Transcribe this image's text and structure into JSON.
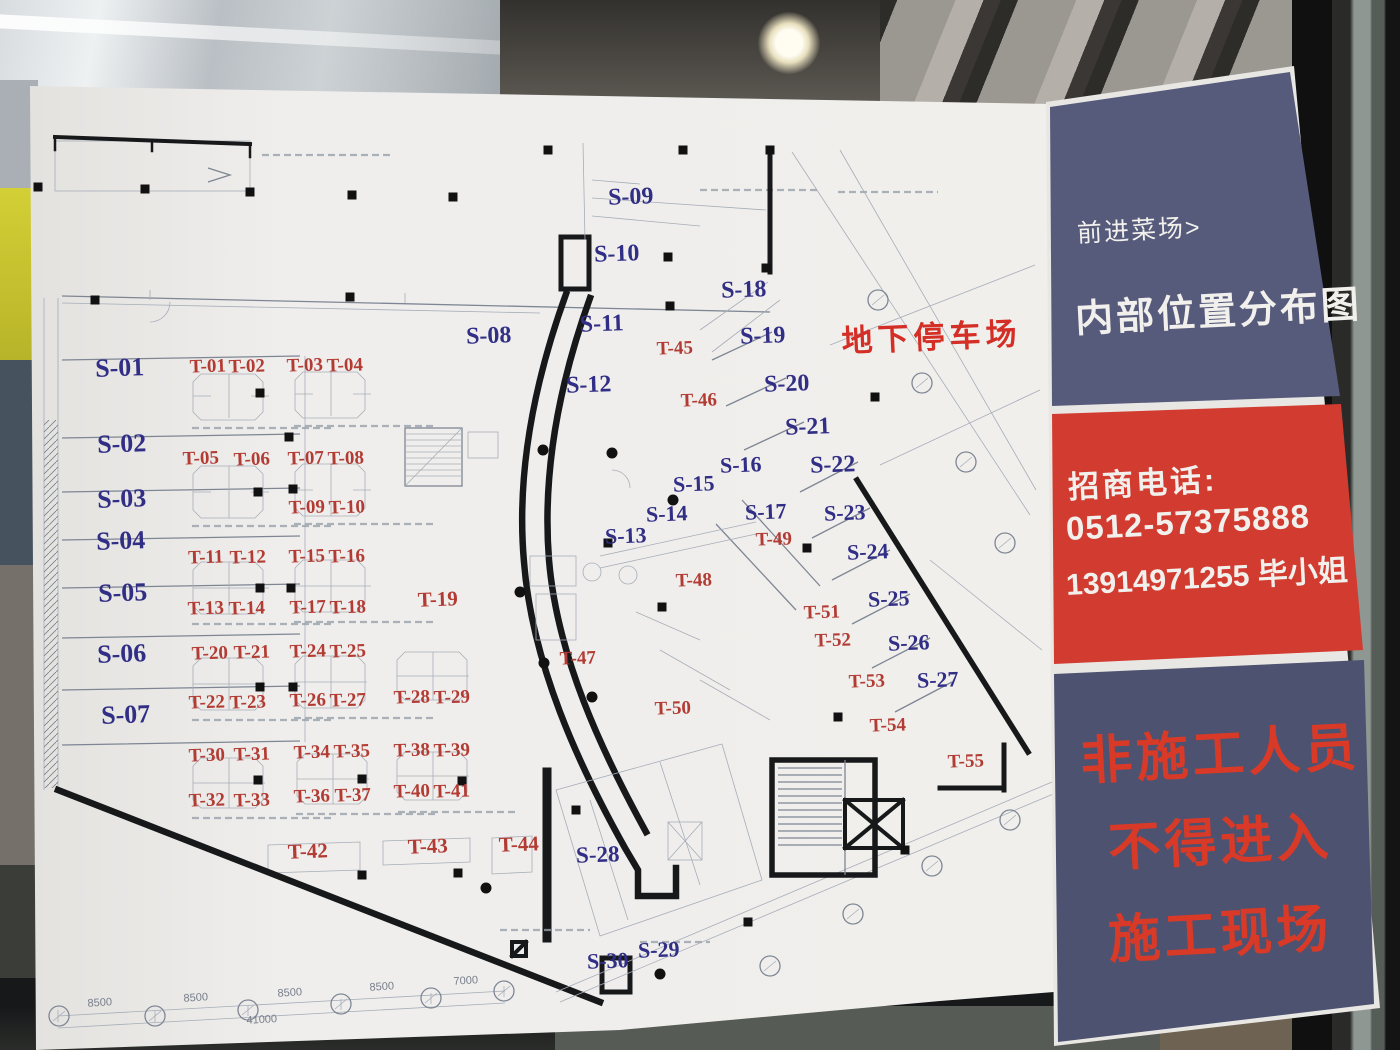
{
  "sidebar": {
    "venue": "前进菜场>",
    "title": "内部位置分布图",
    "contact_heading": "招商电话:",
    "phone_landline": "0512-57375888",
    "phone_mobile": "13914971255 毕小姐",
    "warning_lines": [
      "非施工人员",
      "不得进入",
      "施工现场"
    ],
    "colors": {
      "panel_navy_top": "#565b7c",
      "panel_red": "#d23b30",
      "panel_navy_bottom": "#4d5270",
      "warning_red": "#d93a28"
    }
  },
  "plan": {
    "parking_label": {
      "text": "地下停车场",
      "x": 932,
      "y": 348,
      "color": "#d42f26",
      "fs": 31
    },
    "label_colors": {
      "s": "#312e85",
      "t": "#b23b33"
    },
    "stalls_s": [
      {
        "id": "S-01",
        "x": 120,
        "y": 376,
        "fs": 26
      },
      {
        "id": "S-02",
        "x": 122,
        "y": 452,
        "fs": 26
      },
      {
        "id": "S-03",
        "x": 122,
        "y": 507,
        "fs": 26
      },
      {
        "id": "S-04",
        "x": 121,
        "y": 549,
        "fs": 26
      },
      {
        "id": "S-05",
        "x": 123,
        "y": 601,
        "fs": 26
      },
      {
        "id": "S-06",
        "x": 122,
        "y": 662,
        "fs": 26
      },
      {
        "id": "S-07",
        "x": 126,
        "y": 723,
        "fs": 26
      },
      {
        "id": "S-08",
        "x": 489,
        "y": 343,
        "fs": 24
      },
      {
        "id": "S-09",
        "x": 631,
        "y": 204,
        "fs": 24
      },
      {
        "id": "S-10",
        "x": 617,
        "y": 261,
        "fs": 24
      },
      {
        "id": "S-11",
        "x": 602,
        "y": 331,
        "fs": 24
      },
      {
        "id": "S-12",
        "x": 589,
        "y": 392,
        "fs": 24
      },
      {
        "id": "S-13",
        "x": 626,
        "y": 543,
        "fs": 22
      },
      {
        "id": "S-14",
        "x": 667,
        "y": 521,
        "fs": 22
      },
      {
        "id": "S-15",
        "x": 694,
        "y": 491,
        "fs": 22
      },
      {
        "id": "S-16",
        "x": 741,
        "y": 472,
        "fs": 22
      },
      {
        "id": "S-17",
        "x": 766,
        "y": 519,
        "fs": 22
      },
      {
        "id": "S-18",
        "x": 744,
        "y": 297,
        "fs": 24
      },
      {
        "id": "S-19",
        "x": 763,
        "y": 343,
        "fs": 24
      },
      {
        "id": "S-20",
        "x": 787,
        "y": 391,
        "fs": 24
      },
      {
        "id": "S-21",
        "x": 808,
        "y": 434,
        "fs": 24
      },
      {
        "id": "S-22",
        "x": 833,
        "y": 472,
        "fs": 24
      },
      {
        "id": "S-23",
        "x": 845,
        "y": 520,
        "fs": 22
      },
      {
        "id": "S-24",
        "x": 868,
        "y": 559,
        "fs": 22
      },
      {
        "id": "S-25",
        "x": 889,
        "y": 606,
        "fs": 22
      },
      {
        "id": "S-26",
        "x": 909,
        "y": 650,
        "fs": 22
      },
      {
        "id": "S-27",
        "x": 938,
        "y": 687,
        "fs": 22
      },
      {
        "id": "S-28",
        "x": 598,
        "y": 862,
        "fs": 23
      },
      {
        "id": "S-29",
        "x": 659,
        "y": 957,
        "fs": 22
      },
      {
        "id": "S-30",
        "x": 608,
        "y": 968,
        "fs": 22
      }
    ],
    "stalls_t": [
      {
        "id": "T-01",
        "x": 208,
        "y": 372
      },
      {
        "id": "T-02",
        "x": 247,
        "y": 372
      },
      {
        "id": "T-03",
        "x": 305,
        "y": 371
      },
      {
        "id": "T-04",
        "x": 345,
        "y": 371
      },
      {
        "id": "T-05",
        "x": 201,
        "y": 464
      },
      {
        "id": "T-06",
        "x": 252,
        "y": 465
      },
      {
        "id": "T-07",
        "x": 306,
        "y": 464
      },
      {
        "id": "T-08",
        "x": 346,
        "y": 464
      },
      {
        "id": "T-09",
        "x": 307,
        "y": 513
      },
      {
        "id": "T-10",
        "x": 347,
        "y": 513
      },
      {
        "id": "T-11",
        "x": 206,
        "y": 563
      },
      {
        "id": "T-12",
        "x": 248,
        "y": 563
      },
      {
        "id": "T-13",
        "x": 206,
        "y": 614
      },
      {
        "id": "T-14",
        "x": 247,
        "y": 614
      },
      {
        "id": "T-15",
        "x": 307,
        "y": 562
      },
      {
        "id": "T-16",
        "x": 347,
        "y": 562
      },
      {
        "id": "T-17",
        "x": 308,
        "y": 613
      },
      {
        "id": "T-18",
        "x": 348,
        "y": 613
      },
      {
        "id": "T-19",
        "x": 438,
        "y": 606,
        "fs": 21
      },
      {
        "id": "T-20",
        "x": 210,
        "y": 659
      },
      {
        "id": "T-21",
        "x": 252,
        "y": 658
      },
      {
        "id": "T-22",
        "x": 207,
        "y": 708
      },
      {
        "id": "T-23",
        "x": 248,
        "y": 708
      },
      {
        "id": "T-24",
        "x": 308,
        "y": 657
      },
      {
        "id": "T-25",
        "x": 348,
        "y": 657
      },
      {
        "id": "T-26",
        "x": 308,
        "y": 706
      },
      {
        "id": "T-27",
        "x": 348,
        "y": 706
      },
      {
        "id": "T-28",
        "x": 412,
        "y": 703
      },
      {
        "id": "T-29",
        "x": 452,
        "y": 703
      },
      {
        "id": "T-30",
        "x": 207,
        "y": 761
      },
      {
        "id": "T-31",
        "x": 252,
        "y": 760
      },
      {
        "id": "T-32",
        "x": 207,
        "y": 806
      },
      {
        "id": "T-33",
        "x": 252,
        "y": 806
      },
      {
        "id": "T-34",
        "x": 312,
        "y": 758
      },
      {
        "id": "T-35",
        "x": 352,
        "y": 757
      },
      {
        "id": "T-36",
        "x": 312,
        "y": 802
      },
      {
        "id": "T-37",
        "x": 353,
        "y": 801
      },
      {
        "id": "T-38",
        "x": 412,
        "y": 756
      },
      {
        "id": "T-39",
        "x": 452,
        "y": 756
      },
      {
        "id": "T-40",
        "x": 412,
        "y": 797
      },
      {
        "id": "T-41",
        "x": 452,
        "y": 797
      },
      {
        "id": "T-42",
        "x": 308,
        "y": 858,
        "fs": 21
      },
      {
        "id": "T-43",
        "x": 428,
        "y": 853,
        "fs": 21
      },
      {
        "id": "T-44",
        "x": 519,
        "y": 851,
        "fs": 21
      },
      {
        "id": "T-45",
        "x": 675,
        "y": 354
      },
      {
        "id": "T-46",
        "x": 699,
        "y": 406
      },
      {
        "id": "T-47",
        "x": 578,
        "y": 664
      },
      {
        "id": "T-48",
        "x": 694,
        "y": 586
      },
      {
        "id": "T-49",
        "x": 774,
        "y": 545
      },
      {
        "id": "T-50",
        "x": 673,
        "y": 714
      },
      {
        "id": "T-51",
        "x": 822,
        "y": 618
      },
      {
        "id": "T-52",
        "x": 833,
        "y": 646
      },
      {
        "id": "T-53",
        "x": 867,
        "y": 687
      },
      {
        "id": "T-54",
        "x": 888,
        "y": 731
      },
      {
        "id": "T-55",
        "x": 966,
        "y": 767
      }
    ],
    "dimensions": [
      {
        "t": "8500",
        "x": 100,
        "y": 1006,
        "r": -3.5
      },
      {
        "t": "8500",
        "x": 196,
        "y": 1001,
        "r": -3.5
      },
      {
        "t": "8500",
        "x": 290,
        "y": 996,
        "r": -3.5
      },
      {
        "t": "8500",
        "x": 382,
        "y": 990,
        "r": -3.5
      },
      {
        "t": "7000",
        "x": 466,
        "y": 984,
        "r": -3.5
      },
      {
        "t": "41000",
        "x": 262,
        "y": 1023,
        "r": -3.5
      }
    ],
    "grid_bubbles": [
      [
        59,
        1016
      ],
      [
        155,
        1016
      ],
      [
        248,
        1010
      ],
      [
        341,
        1004
      ],
      [
        431,
        998
      ],
      [
        504,
        991
      ],
      [
        770,
        966
      ],
      [
        853,
        914
      ],
      [
        932,
        866
      ],
      [
        1010,
        820
      ],
      [
        878,
        300
      ],
      [
        922,
        383
      ],
      [
        966,
        462
      ],
      [
        1005,
        543
      ]
    ],
    "columns": [
      [
        38,
        187
      ],
      [
        145,
        189
      ],
      [
        250,
        192
      ],
      [
        352,
        195
      ],
      [
        453,
        197
      ],
      [
        548,
        150
      ],
      [
        683,
        150
      ],
      [
        668,
        257
      ],
      [
        95,
        300
      ],
      [
        350,
        297
      ],
      [
        670,
        306
      ],
      [
        289,
        437
      ],
      [
        293,
        489
      ],
      [
        291,
        588
      ],
      [
        293,
        687
      ],
      [
        260,
        393
      ],
      [
        258,
        492
      ],
      [
        260,
        588
      ],
      [
        260,
        687
      ],
      [
        258,
        780
      ],
      [
        362,
        779
      ],
      [
        462,
        781
      ],
      [
        362,
        875
      ],
      [
        458,
        873
      ],
      [
        608,
        543
      ],
      [
        662,
        607
      ],
      [
        807,
        548
      ],
      [
        838,
        717
      ],
      [
        905,
        850
      ],
      [
        576,
        810
      ],
      [
        748,
        922
      ],
      [
        770,
        150
      ],
      [
        766,
        268
      ],
      [
        875,
        397
      ]
    ],
    "dots": [
      [
        543,
        450
      ],
      [
        612,
        453
      ],
      [
        673,
        500
      ],
      [
        520,
        592
      ],
      [
        544,
        663
      ],
      [
        592,
        697
      ],
      [
        486,
        888
      ],
      [
        660,
        974
      ]
    ]
  }
}
